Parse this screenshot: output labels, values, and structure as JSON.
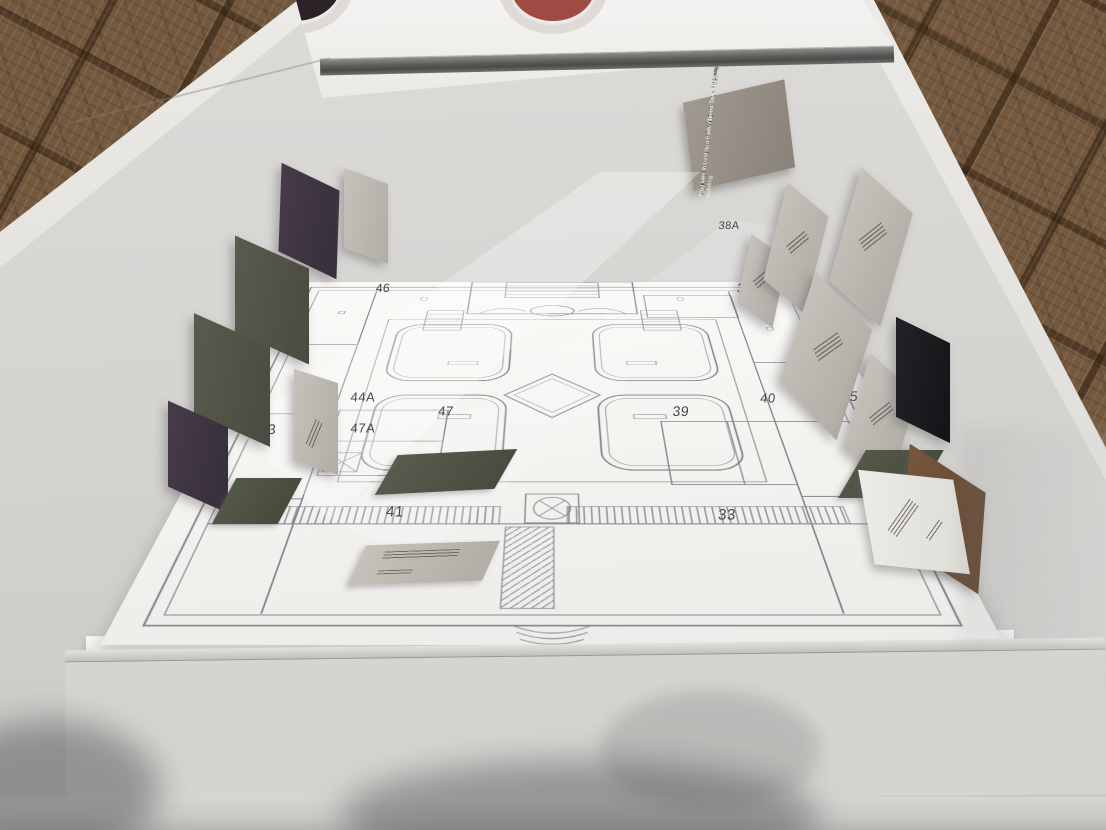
{
  "plaque": {
    "danish_line1": "Leg med farverne fra Vilhelm Dahlerups bygning.",
    "danish_line2": "Du må gerne tage dine yndlingsfarver med hjem.",
    "english_line1": "Play with the colours from Vilhelm Dahlerup's building.",
    "english_line2": "Feel free to take home your favourite colours."
  },
  "plan": {
    "room_numbers": [
      "45",
      "46",
      "44",
      "43",
      "44A",
      "47A",
      "47",
      "41",
      "38A",
      "37",
      "38",
      "36",
      "39",
      "40",
      "35",
      "33"
    ]
  },
  "swatches": {
    "colors": [
      "#1e2231",
      "#5f2b36",
      "#7f7c6a",
      "#ecaa5f",
      "#5d5c49",
      "#c66457",
      "#474e4c",
      "#a84b47",
      "#454f47",
      "#d7a168",
      "#8a8875",
      "#5c3147",
      "#1d2233"
    ]
  },
  "vitrine": {
    "dish_colors": [
      "#6a6350",
      "#2e2229",
      "#a04a44"
    ]
  }
}
